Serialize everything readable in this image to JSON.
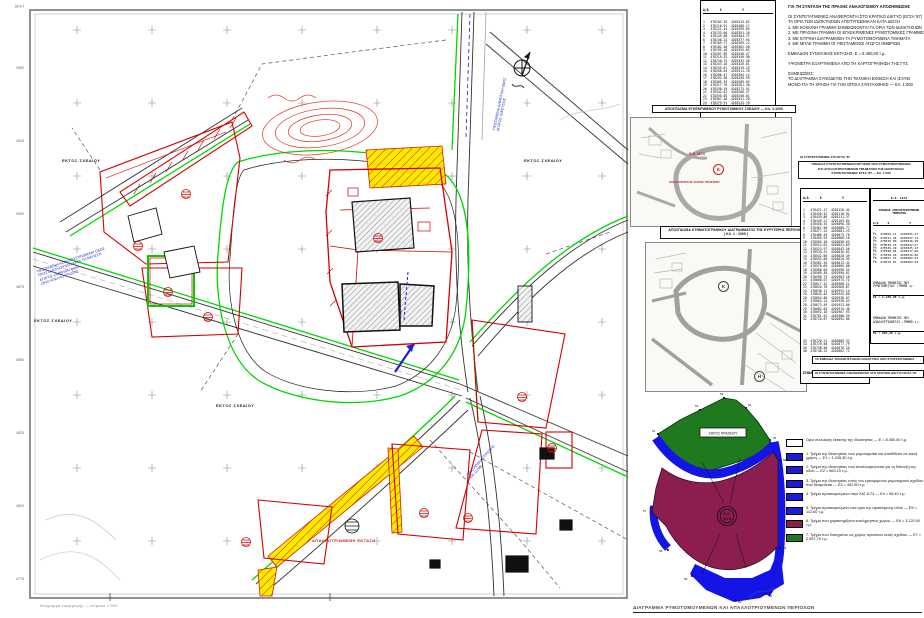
{
  "page": {
    "bottom_title": "ΔΙΑΓΡΑΜΜΑ ΡΥΜΟΤΟΜΟΥΜΕΝΩΝ ΚΑΙ ΑΠΑΛΛΟΤΡΙΟΥΜΕΝΩΝ ΠΕΡΙΟΧΩΝ",
    "bottom_left_note": "διάγραμμα εφαρμογής — κλίμακα 1:500",
    "frame_corner_label": "(χλμ.)"
  },
  "map": {
    "labels": {
      "out_of_plan": "ΕΚΤΟΣ ΣΧΕΔΙΟΥ",
      "expropriated_area": "ΑΠΑΛΛΟΤΡΙΩΜΕΝΗ ΕΚΤΑΣΗ",
      "north_letter": "Β"
    },
    "blue_notes": {
      "left": "ΥΦΙΣΤΑΜΕΝΗ ΑΣΦΑΛΤΟΣΤΡΩΜΕΝΗ ΟΔΟΣ\nΠΡΟΣ ΔΙΑΠΛΑΤΥΝΣΗ ΚΑΤΑ ΤΗ ΜΕΛΕΤΗ\nΑΓΩΓΟΣ ΟΜΒΡΙΩΝ Φ600\nΟΡΙΟ ΑΠΑΛΛΟΤΡΙΩΣΗΣ",
      "along_road": "ΥΦΙΣΤΑΜΕΝΗ ΔΗΜΟΤΙΚΗ ΟΔΟΣ\nΑΓΩΓΟΣ ΥΔΡΕΥΣΗΣ",
      "junction": "ΟΡΙΟ ΑΠΑΛΛΟΤΡΙΩΣΗΣ\nΚΜ 1174Β",
      "pipe": "Φ600"
    },
    "ticks_left": [
      "4950",
      "4925",
      "4900",
      "4875",
      "4850",
      "4825",
      "4800",
      "4775"
    ]
  },
  "right_column": {
    "table_a": {
      "header": "Α/Α      Χ           Υ",
      "rows": [
        "1   478102.35  4203415.82",
        "2   478110.91  4203408.17",
        "3   478121.44  4203399.05",
        "4   478133.60  4203391.26",
        "5   478145.08  4203384.71",
        "6   478158.23  4203377.94",
        "7   478169.77  4203369.12",
        "8   478182.40  4203362.58",
        "9   478195.16  4203355.03",
        "10  478207.89  4203348.47",
        "11  478219.32  4203340.90",
        "12  478230.75  4203333.36",
        "13  478243.18  4203326.81",
        "14  478255.61  4203319.25",
        "15  478268.04  4203311.70",
        "16  478280.47  4203304.14",
        "17  478292.90  4203296.59",
        "18  478305.33  4203289.03",
        "19  478317.76  4203281.48",
        "20  478330.19  4203273.92",
        "21  478342.62  4203266.37",
        "22  478355.05  4203258.81",
        "23  478367.48  4203251.26",
        "24  478379.91  4203243.70",
        "25  478392.34  4203236.15"
      ]
    },
    "notes_lines": [
      "ΓΙΑ ΤΗ ΣΥΝΤΑΞΗ ΤΗΣ ΠΡΑΞΗΣ ΑΝΑΛΟΓΙΣΜΟΥ ΑΠΟΖΗΜΙΩΣΗΣ",
      "",
      "ΟΙ ΣΥΝΤΕΤΑΓΜΕΝΕΣ ΑΝΑΦΕΡΟΝΤΑΙ ΣΤΟ ΚΡΑΤΙΚΟ ΔΙΚΤΥΟ (ΕΓΣΑ '87)",
      "ΤΑ ΟΡΙΑ ΤΩΝ ΙΔΙΟΚΤΗΣΙΩΝ ΑΠΟΤΥΠΩΘΗΚΑΝ ΚΑΤΑ ΔΕΙΞΗ",
      "1. ΜΕ ΚΟΚΚΙΝΗ ΓΡΑΜΜΗ ΣΗΜΕΙΩΝΟΝΤΑΙ ΤΑ ΟΡΙΑ ΤΩΝ ΙΔΙΟΚΤΗΣΙΩΝ",
      "2. ΜΕ ΠΡΑΣΙΝΗ ΓΡΑΜΜΗ ΟΙ ΕΓΚΕΚΡΙΜΕΝΕΣ ΡΥΜΟΤΟΜΙΚΕΣ ΓΡΑΜΜΕΣ",
      "3. ΜΕ ΚΙΤΡΙΝΗ ΔΙΑΓΡΑΜΜΙΣΗ ΤΑ ΡΥΜΟΤΟΜΟΥΜΕΝΑ ΤΜΗΜΑΤΑ",
      "4. ΜΕ ΜΠΛΕ ΓΡΑΜΜΗ ΟΙ ΥΦΙΣΤΑΜΕΝΟΙ ΑΓΩΓΟΙ ΟΜΒΡΙΩΝ",
      "",
      "ΕΜΒΑΔΟΝ ΣΥΝΟΛΙΚΗΣ ΕΚΤΑΣΗΣ: Ε = 8.450,00 τ.μ.",
      "",
      "ΥΨΟΜΕΤΡΑ ΕΞΑΡΤΗΜΕΝΑ ΑΠΟ ΤΗ ΧΑΡΤΟΓΡΑΦΗΣΗ ΤΗΣ ΓΥΣ",
      "",
      "ΣΗΜΕΙΩΣΕΙΣ:",
      "ΤΟ ΔΙΑΓΡΑΜΜΑ ΣΥΝΟΔΕΥΕΙ ΤΗΝ ΤΕΧΝΙΚΗ ΕΚΘΕΣΗ ΚΑΙ ΙΣΧΥΕΙ",
      "ΜΟΝΟ ΓΙΑ ΤΗ ΧΡΗΣΗ ΓΙΑ ΤΗΝ ΟΠΟΙΑ ΣΥΝΤΑΧΘΗΚΕ — ΚΛ. 1:500"
    ],
    "inset1": {
      "title": "ΑΠΟΣΠΑΣΜΑ ΕΓΚΕΚΡΙΜΕΝΟΥ ΡΥΜΟΤΟΜΙΚΟΥ ΣΧΕΔΙΟΥ — ΚΛ. 1:1000",
      "red_label_top": "Κ.Χ. 1174",
      "red_circle_letter": "Κ",
      "red_label_bottom": "ΚΟΙΝΟΧΡΗΣΤΟΣ ΧΩΡΟΣ ΠΡΑΣΙΝΟΥ"
    },
    "inset2": {
      "title_line1": "ΑΠΟΣΠΑΣΜΑ ΚΤΗΜΑΤΟΓΡΑΦΙΚΟΥ ΔΙΑΓΡΑΜΜΑΤΟΣ ΤΗΣ ΕΥΡΥΤΕΡΗΣ ΠΕΡΙΟΧΗΣ",
      "title_line2": "( ΚΛ. 1 : 1000 )",
      "circle_k": "Κ",
      "circle_h": "Η"
    },
    "tables_note": "ΟΙ ΣΥΝΤΕΤΑΓΜΕΝΕΣ ΣΤΟ ΕΓΣΑ '87",
    "tables_header": {
      "lines": [
        "ΠΙΝΑΚΑΣ ΣΥΝΤΕΤΑΓΜΕΝΩΝ ΚΟΡΥΦΩΝ ΤΩΝ ΡΥΜΟΤΟΜΟΥΜΕΝΩΝ",
        "ΚΑΙ ΑΠΑΛΛΟΤΡΙΟΥΜΕΝΩΝ ΤΜΗΜΑΤΩΝ ΤΗΣ ΙΔΙΟΚΤΗΣΙΑΣ",
        "ΣΥΝΤΕΤΑΓΜΕΝΕΣ ΕΓΣΑ '87 — ΚΛ. 1:500"
      ]
    },
    "long_table": {
      "header": "Α/Α      Χ           Υ",
      "rows": [
        "1   478421.17  4203126.44",
        "2   478430.52  4203118.91",
        "3   478439.86  4203111.37",
        "4   478449.21  4203103.84",
        "5   478458.55  4203096.30",
        "6   478467.90  4203088.77",
        "7   478477.24  4203081.23",
        "8   478486.59  4203073.70",
        "9   478495.93  4203066.16",
        "10  478505.28  4203058.63",
        "11  478514.62  4203051.09",
        "12  478523.97  4203043.56",
        "13  478533.31  4203036.02",
        "14  478542.66  4203028.49",
        "15  478552.00  4203020.95",
        "16  478561.35  4203013.42",
        "17  478570.69  4203005.88",
        "18  478580.04  4202998.35",
        "19  478589.38  4202990.81",
        "20  478598.73  4202983.28",
        "21  478608.07  4202975.74",
        "22  478617.42  4202968.21",
        "23  478626.76  4202960.67",
        "24  478636.11  4202953.14",
        "25  478645.45  4202945.60",
        "26  478654.80  4202938.07",
        "27  478664.14  4202930.53",
        "28  478673.49  4202923.00",
        "29  478682.83  4202915.46",
        "30  478692.18  4202907.93",
        "31  478701.52  4202900.39",
        "32  478710.87  4202892.86"
      ],
      "rows2": [
        "33  478720.21  4202885.32",
        "34  478729.56  4202877.79",
        "35  478738.90  4202870.25",
        "36  478748.25  4202862.72"
      ],
      "footer": [
        "ΣΥΝΟΛΙΚΟ ΕΜΒΑΔΟΝ: Ε = 8.450,00 τ.μ."
      ]
    },
    "side_table": {
      "title": "Κ.Χ. 1174",
      "subtitle": "ΠΙΝΑΚΑΣ ΑΠΑΛΛΟΤΡΙΟΥΜΕΝΩΝ ΤΜΗΜΑΤΩΝ",
      "header": "Α/Α     Χ           Υ",
      "rows": [
        "Ρ1  478502.11  4203055.27",
        "Ρ2  478511.46  4203047.74",
        "Ρ3  478520.80  4203040.20",
        "Ρ4  478530.15  4203032.67",
        "Ρ5  478539.49  4203025.13",
        "Ρ6  478548.84  4203017.60",
        "Ρ7  478558.18  4203010.06",
        "Ρ8  478567.53  4203002.53",
        "Ρ9  478576.87  4202994.99"
      ],
      "note1": "ΕΜΒΑΔΟΝ ΤΜΗΜΑΤΟΣ ΠΟΥ\nΡΥΜΟΤΟΜΕΙΤΑΙ (ΤΜΗΜΑ 1):",
      "sum1": "Ε1 = 1.245,30 τ.μ.",
      "note2": "ΕΜΒΑΔΟΝ ΤΜΗΜΑΤΟΣ ΠΟΥ\nΑΠΑΛΛΟΤΡΙΩΝΕΤΑΙ (ΤΜΗΜΑ 2):",
      "sum2": "Ε2 = 863,15 τ.μ."
    },
    "box_line_1": "ΤΑ ΕΜΒΑΔΑ ΥΠΟΛΟΓΙΣΤΗΚΑΝ ΑΝΑΛΥΤΙΚΑ ΑΠΟ ΣΥΝΤΕΤΑΓΜΕΝΕΣ",
    "box_line_2": "ΟΙ ΣΥΝΤΕΤΑΓΜΕΝΕΣ ΑΝΑΦΕΡΟΝΤΑΙ ΣΤΟ ΚΡΑΤΙΚΟ ΔΙΚΤΥΟ ΕΓΣΑ '87"
  },
  "diagram": {
    "road_box_label": "ΧΩΡΟΣ ΠΡΑΣΙΝΟΥ",
    "circle_top": "Κ.Χ.",
    "circle_bottom": "1174",
    "point_labels": [
      "51",
      "52",
      "53",
      "54",
      "55",
      "56",
      "57",
      "58",
      "59",
      "60",
      "61",
      "62"
    ],
    "colors": {
      "green": "#1f7a1f",
      "blue": "#1414e6",
      "maroon": "#8b1e4f"
    }
  },
  "legend": {
    "items": [
      {
        "color": "#ffffff",
        "text": "Όριο συνολικής έκτασης της ιδιοκτησίας — Ε = 8.450,00 τ.μ."
      },
      {
        "color": "#1b1bd8",
        "text": "1. Τμήμα της ιδιοκτησίας που ρυμοτομείται και αποδίδεται σε κοινή χρήση — Ε1 = 1.245,30 τ.μ."
      },
      {
        "color": "#1b1bd8",
        "text": "2. Τμήμα της ιδιοκτησίας που απαλλοτριώνεται για τη διάνοιξη της οδού — Ε2 = 863,15 τ.μ."
      },
      {
        "color": "#1b1bd8",
        "text": "3. Τμήμα της ιδιοκτησίας εντός του εγκεκριμένου ρυμοτομικού σχεδίου που δεσμεύεται — Ε3 = 452,80 τ.μ."
      },
      {
        "color": "#1b1bd8",
        "text": "4. Τμήμα προσκυρούμενο στην ΚΜ 1174 — Ε4 = 98,40 τ.μ."
      },
      {
        "color": "#1b1bd8",
        "text": "5. Τμήμα προσκυρούμενο στα όρια της υφιστάμενης οδού — Ε5 = 112,60 τ.μ."
      },
      {
        "color": "#8b1e4f",
        "text": "6. Τμήμα που χαρακτηρίζεται κοινόχρηστος χώρος — Ε6 = 3.120,00 τ.μ."
      },
      {
        "color": "#1f7a1f",
        "text": "7. Τμήμα που διατηρείται ως χώρος πρασίνου εκτός σχεδίου — Ε7 = 2.557,75 τ.μ."
      }
    ]
  }
}
